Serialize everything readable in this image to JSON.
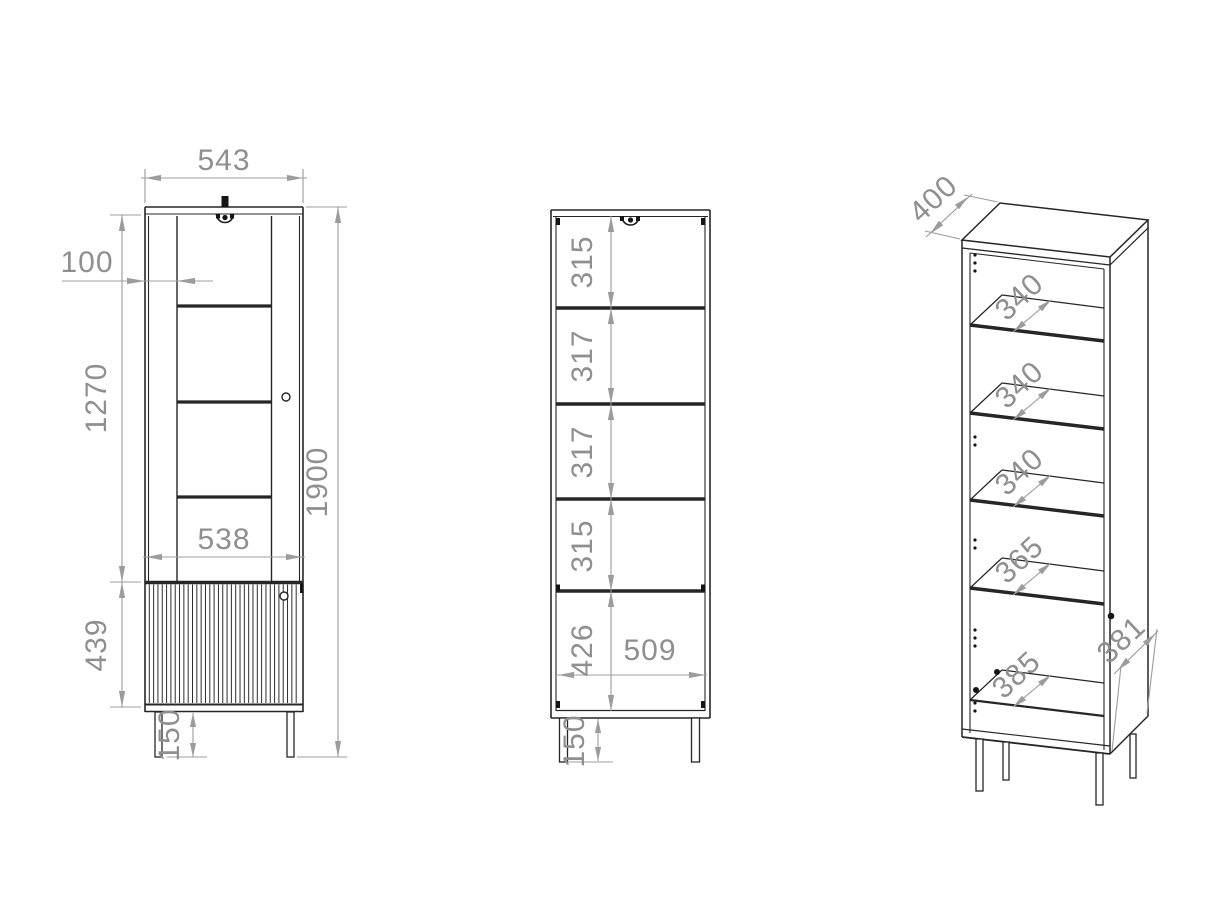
{
  "drawing": {
    "background": "#ffffff",
    "line_color": "#262626",
    "dim_color": "#9c9c9c",
    "text_color": "#8f8f8f",
    "front_view": {
      "name": "front view, doors closed",
      "dims": {
        "top_width": "543",
        "stile_width": "100",
        "glass_door_height": "1270",
        "lower_door_height": "439",
        "door_width": "538",
        "leg_height": "150",
        "total_height": "1900"
      }
    },
    "open_view": {
      "name": "front view, doors removed",
      "dims": {
        "shelf_gap_1": "315",
        "shelf_gap_2": "317",
        "shelf_gap_3": "317",
        "shelf_gap_4": "315",
        "bottom_compartment_height": "426",
        "interior_width": "509",
        "leg_height": "150"
      }
    },
    "iso_view": {
      "name": "isometric view",
      "dims": {
        "top_depth": "400",
        "shelf_1_depth": "340",
        "shelf_2_depth": "340",
        "shelf_3_depth": "340",
        "shelf_4_depth": "365",
        "bottom_depth": "385",
        "side_depth": "381"
      }
    }
  }
}
